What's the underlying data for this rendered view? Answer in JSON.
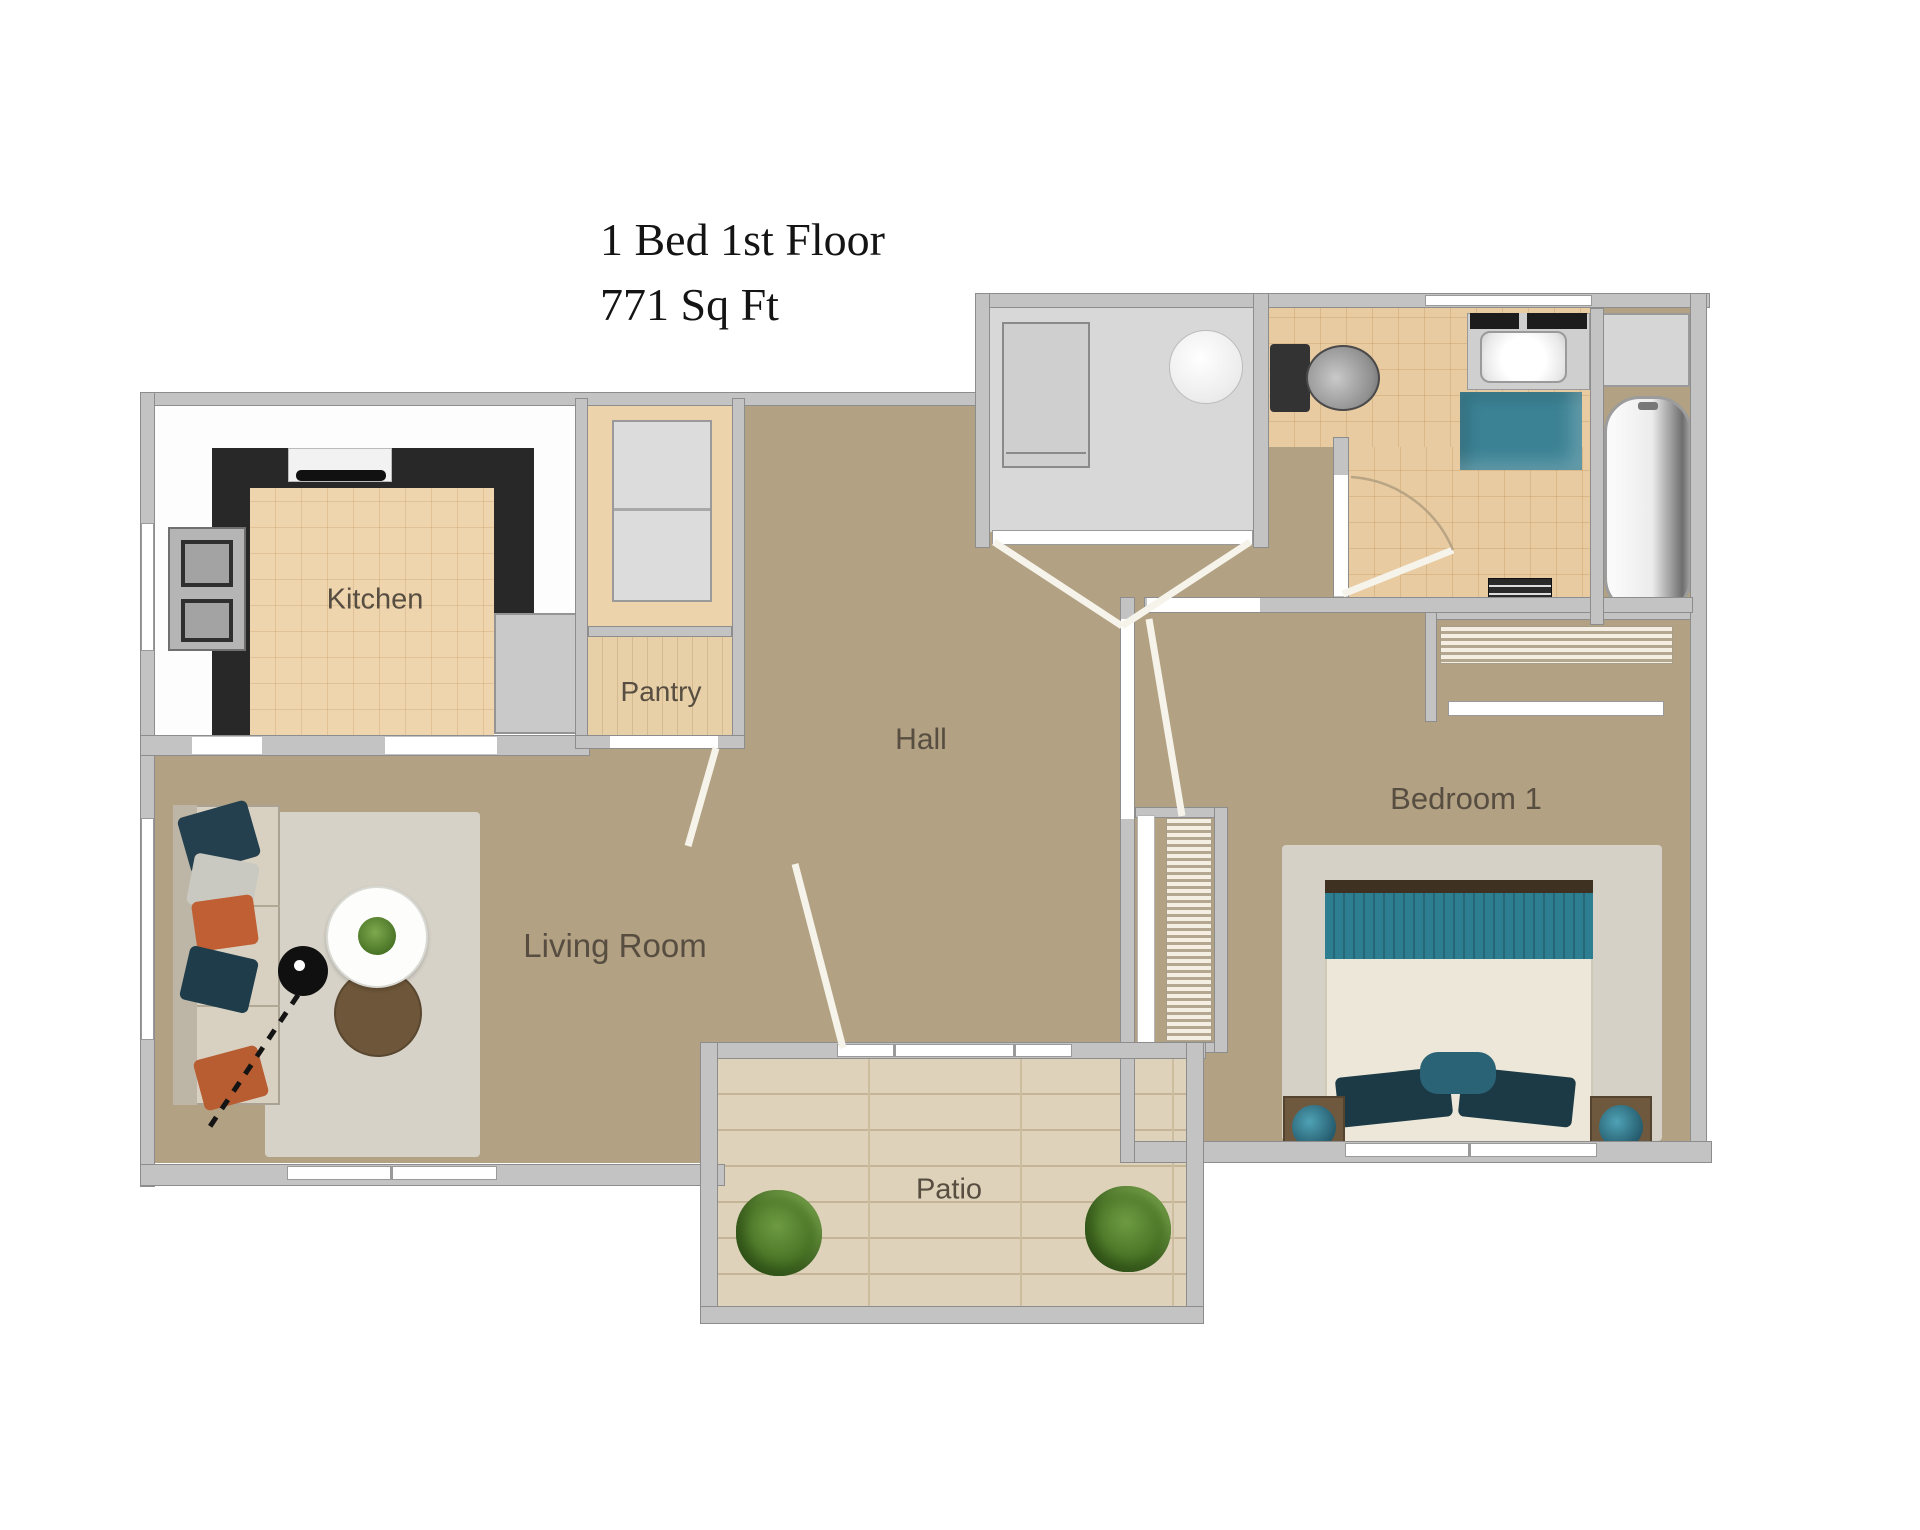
{
  "title": {
    "line1": "1 Bed 1st Floor",
    "line2": "771 Sq Ft"
  },
  "rooms": {
    "kitchen": "Kitchen",
    "pantry": "Pantry",
    "hall": "Hall",
    "living_room": "Living Room",
    "bedroom": "Bedroom 1",
    "patio": "Patio"
  },
  "colors": {
    "wall_gray": "#c3c3c3",
    "floor_tan": "#b2a183",
    "kitchen_tile": "#eed5ae",
    "bath_tile": "#e9cba1",
    "counter_black": "#282828",
    "accent_teal": "#2e7e91",
    "patio_wood": "#ded3ba",
    "rug_gray": "#d6d2c8",
    "plant_green": "#4e7d2b",
    "label_brown": "#574e41"
  }
}
